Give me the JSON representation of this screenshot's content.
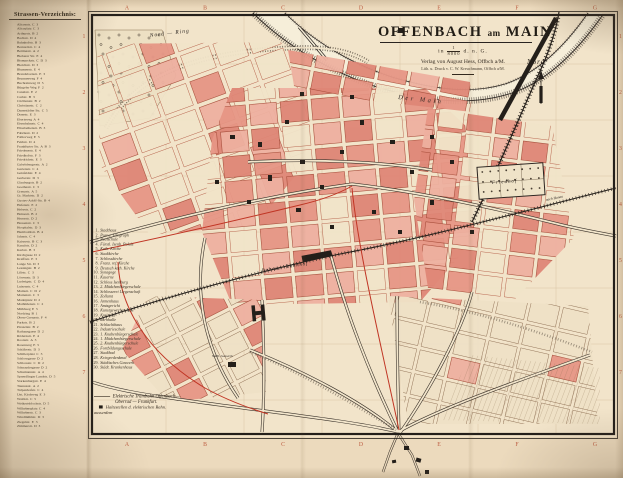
{
  "colors": {
    "paper": "#ecdabd",
    "map_paper": "#f2e4ca",
    "block_pink": "#e69685",
    "block_pink_light": "#eeb0a0",
    "block_pink_strong": "#df8676",
    "ink": "#2a2420",
    "grid_red": "#b5472c",
    "tram_red": "#c03524"
  },
  "street_index": {
    "title": "Strassen-Verzeichnis:",
    "entries": [
      {
        "name": "Alicenstr.",
        "ref": "C 3"
      },
      {
        "name": "Aliceplatz",
        "ref": "C 3"
      },
      {
        "name": "Arthurstr.",
        "ref": "B 2"
      },
      {
        "name": "Bachstr.",
        "ref": "D 4"
      },
      {
        "name": "Bahnhofstr.",
        "ref": "B 3"
      },
      {
        "name": "Bernardstr.",
        "ref": "C 4"
      },
      {
        "name": "Bettinastr.",
        "ref": "A 2"
      },
      {
        "name": "Bieberer Str.",
        "ref": "E 4"
      },
      {
        "name": "Bismarckstr.",
        "ref": "C D 3"
      },
      {
        "name": "Bleichstr.",
        "ref": "D 3"
      },
      {
        "name": "Blumenstr.",
        "ref": "E 4"
      },
      {
        "name": "Brandsbornstr.",
        "ref": "E 3"
      },
      {
        "name": "Brunnenweg",
        "ref": "F 4"
      },
      {
        "name": "Buchrainweg",
        "ref": "D 5"
      },
      {
        "name": "Bürgeler Weg",
        "ref": "F 2"
      },
      {
        "name": "Canalstr.",
        "ref": "E 2"
      },
      {
        "name": "Carlstr.",
        "ref": "B 3"
      },
      {
        "name": "Cäcilienstr.",
        "ref": "B 2"
      },
      {
        "name": "Christianstr.",
        "ref": "C 2"
      },
      {
        "name": "Darmstädter Str.",
        "ref": "C 5"
      },
      {
        "name": "Domstr.",
        "ref": "E 3"
      },
      {
        "name": "Ebertsweg",
        "ref": "A 4"
      },
      {
        "name": "Eisenbahnstr.",
        "ref": "C 4"
      },
      {
        "name": "Elisabethenstr.",
        "ref": "B 3"
      },
      {
        "name": "Fabrikstr.",
        "ref": "D 2"
      },
      {
        "name": "Falltorweg",
        "ref": "E 5"
      },
      {
        "name": "Feldstr.",
        "ref": "D 4"
      },
      {
        "name": "Frankfurter Str.",
        "ref": "A B 3"
      },
      {
        "name": "Friedensstr.",
        "ref": "E 4"
      },
      {
        "name": "Friedhofstr.",
        "ref": "F 3"
      },
      {
        "name": "Friedrichstr.",
        "ref": "E 3"
      },
      {
        "name": "Gabelsbergerstr.",
        "ref": "A 2"
      },
      {
        "name": "Gartenstr.",
        "ref": "C 4"
      },
      {
        "name": "Geisfeldstr.",
        "ref": "E 4"
      },
      {
        "name": "Gerberstr.",
        "ref": "D 3"
      },
      {
        "name": "Glauburgstr.",
        "ref": "B 2"
      },
      {
        "name": "Goethestr.",
        "ref": "C 3"
      },
      {
        "name": "Grenzstr.",
        "ref": "A 5"
      },
      {
        "name": "Gr. Marktstr.",
        "ref": "D 2"
      },
      {
        "name": "Gustav-Adolf-Str.",
        "ref": "B 4"
      },
      {
        "name": "Hafenstr.",
        "ref": "E 2"
      },
      {
        "name": "Hebestr.",
        "ref": "C 2"
      },
      {
        "name": "Heinestr.",
        "ref": "B 2"
      },
      {
        "name": "Herrnstr.",
        "ref": "D 2"
      },
      {
        "name": "Hessenstr.",
        "ref": "C 3"
      },
      {
        "name": "Hospitalstr.",
        "ref": "D 3"
      },
      {
        "name": "Humboldtstr.",
        "ref": "B 4"
      },
      {
        "name": "Jahnstr.",
        "ref": "C 4"
      },
      {
        "name": "Kaiserstr.",
        "ref": "B C 3"
      },
      {
        "name": "Kanalstr.",
        "ref": "D 2"
      },
      {
        "name": "Karlstr.",
        "ref": "B 3"
      },
      {
        "name": "Kirchgasse",
        "ref": "D 2"
      },
      {
        "name": "Krafftstr.",
        "ref": "E 3"
      },
      {
        "name": "Lange Str.",
        "ref": "D 3"
      },
      {
        "name": "Lessingstr.",
        "ref": "B 2"
      },
      {
        "name": "Lilistr.",
        "ref": "C 3"
      },
      {
        "name": "Löwenstr.",
        "ref": "D 3"
      },
      {
        "name": "Ludwigstr.",
        "ref": "C D 4"
      },
      {
        "name": "Luisenstr.",
        "ref": "C 4"
      },
      {
        "name": "Mainstr.",
        "ref": "C D 2"
      },
      {
        "name": "Marienstr.",
        "ref": "C 3"
      },
      {
        "name": "Marktplatz",
        "ref": "D 2"
      },
      {
        "name": "Mathildenstr.",
        "ref": "C 2"
      },
      {
        "name": "Mühlweg",
        "ref": "E 5"
      },
      {
        "name": "Nordring",
        "ref": "B 1"
      },
      {
        "name": "Obere Grenzstr.",
        "ref": "F 4"
      },
      {
        "name": "Parkstr.",
        "ref": "B 2"
      },
      {
        "name": "Pirazzistr.",
        "ref": "B 2"
      },
      {
        "name": "Rathausgasse",
        "ref": "D 2"
      },
      {
        "name": "Rödernstr.",
        "ref": "E 4"
      },
      {
        "name": "Roonstr.",
        "ref": "A 3"
      },
      {
        "name": "Rosenweg",
        "ref": "E 5"
      },
      {
        "name": "Schäferstr.",
        "ref": "D 3"
      },
      {
        "name": "Schillerplatz",
        "ref": "C 3"
      },
      {
        "name": "Schlossgasse",
        "ref": "D 2"
      },
      {
        "name": "Schlossstr.",
        "ref": "C D 2"
      },
      {
        "name": "Schnaudergasse",
        "ref": "D 2"
      },
      {
        "name": "Schumannstr.",
        "ref": "A 4"
      },
      {
        "name": "Sprendlinger Landstr.",
        "ref": "D 5"
      },
      {
        "name": "Starkenburgstr.",
        "ref": "E 4"
      },
      {
        "name": "Taunusstr.",
        "ref": "A 2"
      },
      {
        "name": "Tulpenhofstr.",
        "ref": "C 4"
      },
      {
        "name": "Unt. Kirchweg",
        "ref": "E 3"
      },
      {
        "name": "Waldstr.",
        "ref": "C 5"
      },
      {
        "name": "Weikertsblochstr.",
        "ref": "D 5"
      },
      {
        "name": "Wilhelmsplatz",
        "ref": "C 4"
      },
      {
        "name": "Wilhelmstr.",
        "ref": "C 3"
      },
      {
        "name": "Windmühlstr.",
        "ref": "D 3"
      },
      {
        "name": "Ziegelstr.",
        "ref": "E 3"
      },
      {
        "name": "Zimmerstr.",
        "ref": "D 3"
      }
    ]
  },
  "legend": {
    "items": [
      {
        "n": "1.",
        "label": "Stadthaus"
      },
      {
        "n": "2.",
        "label": "Post u. Telegraph"
      },
      {
        "n": "3.",
        "label": "Realschule"
      },
      {
        "n": "4.",
        "label": "Fürstl. Isenb. Palais"
      },
      {
        "n": "5.",
        "label": "Kath. Kirche"
      },
      {
        "n": "6.",
        "label": "Stadtkirche"
      },
      {
        "n": "7.",
        "label": "Schlosskirche"
      },
      {
        "n": "8.",
        "label": "Franz. ref. Kirche"
      },
      {
        "n": "9.",
        "label": "Deutsch kath. Kirche"
      },
      {
        "n": "10.",
        "label": "Synagoge"
      },
      {
        "n": "11.",
        "label": "Kaserne"
      },
      {
        "n": "12.",
        "label": "Schloss Isenburg"
      },
      {
        "n": "13.",
        "label": "2. Mädchenbürgerschule"
      },
      {
        "n": "14.",
        "label": "Schlosserei Liegenschaft"
      },
      {
        "n": "15.",
        "label": "Zollamt"
      },
      {
        "n": "16.",
        "label": "Armenhaus"
      },
      {
        "n": "17.",
        "label": "Amtsgericht"
      },
      {
        "n": "18.",
        "label": "Kunstgewerbeschule"
      },
      {
        "n": "19.",
        "label": "Kreisamt"
      },
      {
        "n": "20.",
        "label": "Turnhalle"
      },
      {
        "n": "21.",
        "label": "Schlachthaus"
      },
      {
        "n": "22.",
        "label": "Industrieschule"
      },
      {
        "n": "23.",
        "label": "1. Knabenbürgerschule"
      },
      {
        "n": "24.",
        "label": "1. Mädchenbürgerschule"
      },
      {
        "n": "25.",
        "label": "2. Knabenbürgerschule"
      },
      {
        "n": "26.",
        "label": "Fortbildungsschule"
      },
      {
        "n": "27.",
        "label": "Stadtbad"
      },
      {
        "n": "28.",
        "label": "Kriegerdenkmal"
      },
      {
        "n": "29.",
        "label": "Städtisches Gaswerk"
      },
      {
        "n": "30.",
        "label": "Städt. Krankenhaus"
      }
    ]
  },
  "tram_note": {
    "line1": "Elektrische Trambahn Offenbach —",
    "line2": "Oberrad — Frankfurt.",
    "line3": "Haltestellen d. elektrischen Bahn.",
    "line4": "ausserdem"
  },
  "title_block": {
    "title_main": "OFFENBACH",
    "title_small": "am",
    "title_end": "MAIN",
    "scale_prefix": "in",
    "scale_num": "1",
    "scale_den": "8000",
    "scale_suffix": "d. n. G.",
    "publisher": "Verlag von August Hess, Offbch a/M.",
    "printer": "Lith. u. Druck v. C. W. Kreuchmann, Offbch a/M."
  },
  "north": {
    "label": "Nord"
  },
  "map_labels": {
    "nord_ring": "Nord — Ring",
    "der_main": "Der Main",
    "bebraer_bahnhof": "Bebraer-Bahnhof",
    "friedhof": "Friedhof",
    "nach_hanau": "nach Hanau",
    "gaswerk": "Städt. Gaswerk"
  },
  "grid": {
    "top": [
      "A",
      "B",
      "C",
      "D",
      "E",
      "F",
      "G"
    ],
    "left": [
      "1",
      "2",
      "3",
      "4",
      "5",
      "6",
      "7"
    ]
  }
}
